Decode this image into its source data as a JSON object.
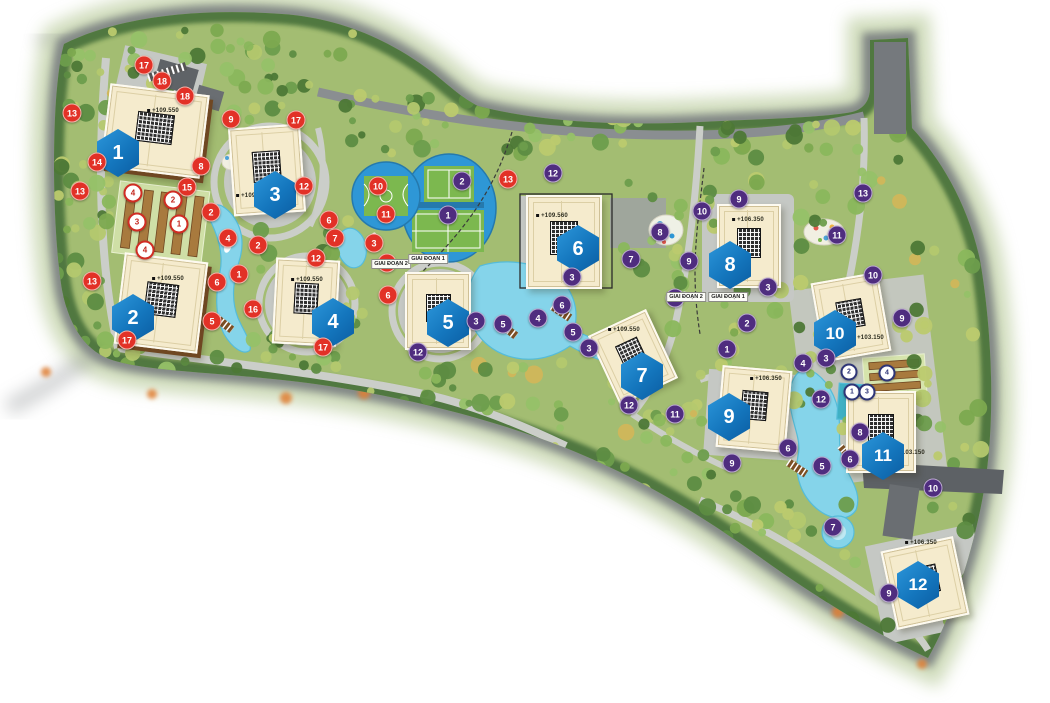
{
  "map": {
    "type": "residential-master-plan",
    "phase_labels": [
      {
        "text": "GIAI ĐOẠN 2",
        "x": 391,
        "y": 264
      },
      {
        "text": "GIAI ĐOẠN 1",
        "x": 428,
        "y": 259
      },
      {
        "text": "GIAI ĐOẠN 2",
        "x": 686,
        "y": 297
      },
      {
        "text": "GIAI ĐOẠN 1",
        "x": 728,
        "y": 297
      }
    ],
    "buildings": [
      {
        "number": "1",
        "elevation": "+109.550",
        "hex": {
          "x": 118,
          "y": 153
        },
        "rect": {
          "cx": 155,
          "cy": 131,
          "w": 96,
          "h": 80,
          "rot": 7
        },
        "style": "brown",
        "elev_pos": {
          "x": 163,
          "y": 111
        }
      },
      {
        "number": "2",
        "elevation": "+109.550",
        "hex": {
          "x": 133,
          "y": 318
        },
        "rect": {
          "cx": 161,
          "cy": 303,
          "w": 80,
          "h": 88,
          "rot": 7
        },
        "style": "brown",
        "elev_pos": {
          "x": 168,
          "y": 279
        }
      },
      {
        "number": "3",
        "elevation": "+109.550",
        "hex": {
          "x": 275,
          "y": 195
        },
        "rect": {
          "cx": 267,
          "cy": 170,
          "w": 68,
          "h": 84,
          "rot": -4
        },
        "style": "plain",
        "elev_pos": {
          "x": 252,
          "y": 196
        }
      },
      {
        "number": "4",
        "elevation": "+109.550",
        "hex": {
          "x": 333,
          "y": 322
        },
        "rect": {
          "cx": 306,
          "cy": 302,
          "w": 60,
          "h": 82,
          "rot": 3
        },
        "style": "plain",
        "elev_pos": {
          "x": 307,
          "y": 280
        }
      },
      {
        "number": "5",
        "elevation": "",
        "hex": {
          "x": 448,
          "y": 323
        },
        "rect": {
          "cx": 438,
          "cy": 311,
          "w": 62,
          "h": 74,
          "rot": 0
        },
        "style": "plain",
        "elev_pos": {
          "x": 0,
          "y": 0
        }
      },
      {
        "number": "6",
        "elevation": "+109.560",
        "hex": {
          "x": 578,
          "y": 249
        },
        "rect": {
          "cx": 564,
          "cy": 242,
          "w": 72,
          "h": 90,
          "rot": 0
        },
        "style": "plain",
        "elev_pos": {
          "x": 552,
          "y": 216
        }
      },
      {
        "number": "7",
        "elevation": "+109.550",
        "hex": {
          "x": 642,
          "y": 376
        },
        "rect": {
          "cx": 633,
          "cy": 357,
          "w": 60,
          "h": 72,
          "rot": -25
        },
        "style": "plain",
        "elev_pos": {
          "x": 624,
          "y": 330
        }
      },
      {
        "number": "8",
        "elevation": "+106.350",
        "hex": {
          "x": 730,
          "y": 265
        },
        "rect": {
          "cx": 749,
          "cy": 246,
          "w": 60,
          "h": 80,
          "rot": 0
        },
        "style": "plain",
        "elev_pos": {
          "x": 748,
          "y": 220
        }
      },
      {
        "number": "9",
        "elevation": "+106.350",
        "hex": {
          "x": 729,
          "y": 417
        },
        "rect": {
          "cx": 754,
          "cy": 409,
          "w": 66,
          "h": 78,
          "rot": 5
        },
        "style": "plain",
        "elev_pos": {
          "x": 766,
          "y": 379
        }
      },
      {
        "number": "10",
        "elevation": "+103.150",
        "hex": {
          "x": 835,
          "y": 334
        },
        "rect": {
          "cx": 851,
          "cy": 317,
          "w": 64,
          "h": 76,
          "rot": -10
        },
        "style": "plain",
        "elev_pos": {
          "x": 868,
          "y": 338
        }
      },
      {
        "number": "11",
        "elevation": "+103.150",
        "hex": {
          "x": 883,
          "y": 456
        },
        "rect": {
          "cx": 881,
          "cy": 432,
          "w": 66,
          "h": 78,
          "rot": 0
        },
        "style": "plain",
        "elev_pos": {
          "x": 909,
          "y": 453
        }
      },
      {
        "number": "12",
        "elevation": "+106.350",
        "hex": {
          "x": 918,
          "y": 585
        },
        "rect": {
          "cx": 925,
          "cy": 583,
          "w": 70,
          "h": 76,
          "rot": -12
        },
        "style": "plain",
        "elev_pos": {
          "x": 921,
          "y": 543
        }
      }
    ],
    "markers": {
      "red": [
        {
          "n": "17",
          "x": 144,
          "y": 65
        },
        {
          "n": "18",
          "x": 162,
          "y": 81
        },
        {
          "n": "18",
          "x": 185,
          "y": 96
        },
        {
          "n": "13",
          "x": 72,
          "y": 113
        },
        {
          "n": "9",
          "x": 231,
          "y": 119
        },
        {
          "n": "17",
          "x": 296,
          "y": 120
        },
        {
          "n": "8",
          "x": 201,
          "y": 166
        },
        {
          "n": "14",
          "x": 97,
          "y": 162
        },
        {
          "n": "15",
          "x": 187,
          "y": 187
        },
        {
          "n": "13",
          "x": 80,
          "y": 191
        },
        {
          "n": "12",
          "x": 304,
          "y": 186
        },
        {
          "n": "2",
          "x": 211,
          "y": 212
        },
        {
          "n": "6",
          "x": 329,
          "y": 220
        },
        {
          "n": "4",
          "x": 228,
          "y": 238
        },
        {
          "n": "2",
          "x": 258,
          "y": 245
        },
        {
          "n": "7",
          "x": 335,
          "y": 238
        },
        {
          "n": "12",
          "x": 316,
          "y": 258
        },
        {
          "n": "1",
          "x": 239,
          "y": 274
        },
        {
          "n": "6",
          "x": 217,
          "y": 282
        },
        {
          "n": "13",
          "x": 92,
          "y": 281
        },
        {
          "n": "10",
          "x": 378,
          "y": 186
        },
        {
          "n": "11",
          "x": 386,
          "y": 214
        },
        {
          "n": "3",
          "x": 374,
          "y": 243
        },
        {
          "n": "2",
          "x": 387,
          "y": 263
        },
        {
          "n": "6",
          "x": 388,
          "y": 295
        },
        {
          "n": "13",
          "x": 508,
          "y": 179
        },
        {
          "n": "5",
          "x": 212,
          "y": 321
        },
        {
          "n": "16",
          "x": 253,
          "y": 309
        },
        {
          "n": "17",
          "x": 127,
          "y": 340
        },
        {
          "n": "17",
          "x": 323,
          "y": 347
        }
      ],
      "purple": [
        {
          "n": "2",
          "x": 462,
          "y": 181
        },
        {
          "n": "1",
          "x": 448,
          "y": 215
        },
        {
          "n": "12",
          "x": 553,
          "y": 173
        },
        {
          "n": "3",
          "x": 572,
          "y": 277
        },
        {
          "n": "6",
          "x": 562,
          "y": 305
        },
        {
          "n": "4",
          "x": 538,
          "y": 318
        },
        {
          "n": "5",
          "x": 573,
          "y": 332
        },
        {
          "n": "3",
          "x": 476,
          "y": 321
        },
        {
          "n": "5",
          "x": 503,
          "y": 324
        },
        {
          "n": "12",
          "x": 418,
          "y": 352
        },
        {
          "n": "3",
          "x": 589,
          "y": 348
        },
        {
          "n": "12",
          "x": 629,
          "y": 405
        },
        {
          "n": "11",
          "x": 675,
          "y": 414
        },
        {
          "n": "8",
          "x": 660,
          "y": 232
        },
        {
          "n": "7",
          "x": 631,
          "y": 259
        },
        {
          "n": "9",
          "x": 689,
          "y": 261
        },
        {
          "n": "10",
          "x": 702,
          "y": 211
        },
        {
          "n": "10",
          "x": 675,
          "y": 298
        },
        {
          "n": "9",
          "x": 739,
          "y": 199
        },
        {
          "n": "13",
          "x": 863,
          "y": 193
        },
        {
          "n": "11",
          "x": 837,
          "y": 235
        },
        {
          "n": "10",
          "x": 873,
          "y": 275
        },
        {
          "n": "9",
          "x": 902,
          "y": 318
        },
        {
          "n": "3",
          "x": 768,
          "y": 287
        },
        {
          "n": "2",
          "x": 747,
          "y": 323
        },
        {
          "n": "1",
          "x": 727,
          "y": 349
        },
        {
          "n": "4",
          "x": 803,
          "y": 363
        },
        {
          "n": "3",
          "x": 826,
          "y": 358
        },
        {
          "n": "12",
          "x": 821,
          "y": 399
        },
        {
          "n": "8",
          "x": 860,
          "y": 432
        },
        {
          "n": "6",
          "x": 788,
          "y": 448
        },
        {
          "n": "6",
          "x": 850,
          "y": 459
        },
        {
          "n": "5",
          "x": 822,
          "y": 466
        },
        {
          "n": "9",
          "x": 732,
          "y": 463
        },
        {
          "n": "7",
          "x": 833,
          "y": 527
        },
        {
          "n": "10",
          "x": 933,
          "y": 488
        },
        {
          "n": "9",
          "x": 889,
          "y": 593
        }
      ],
      "white_red": [
        {
          "n": "4",
          "x": 133,
          "y": 193
        },
        {
          "n": "2",
          "x": 173,
          "y": 200
        },
        {
          "n": "3",
          "x": 137,
          "y": 222
        },
        {
          "n": "1",
          "x": 179,
          "y": 224
        },
        {
          "n": "4",
          "x": 145,
          "y": 250
        }
      ],
      "white_navy": [
        {
          "n": "2",
          "x": 849,
          "y": 372
        },
        {
          "n": "4",
          "x": 887,
          "y": 373
        },
        {
          "n": "1",
          "x": 852,
          "y": 392
        },
        {
          "n": "3",
          "x": 867,
          "y": 392
        }
      ]
    },
    "colors": {
      "hexagon": "#1377bd",
      "red_marker": "#e23127",
      "purple_marker": "#4f2d7f",
      "navy_marker": "#2e3577",
      "water": "#85d4ea",
      "building": "#f5ebcd",
      "court_green": "#7cb84f",
      "court_blue": "#2e97d6",
      "road_dark": "#75797d",
      "road_light": "#cbcec9"
    }
  }
}
